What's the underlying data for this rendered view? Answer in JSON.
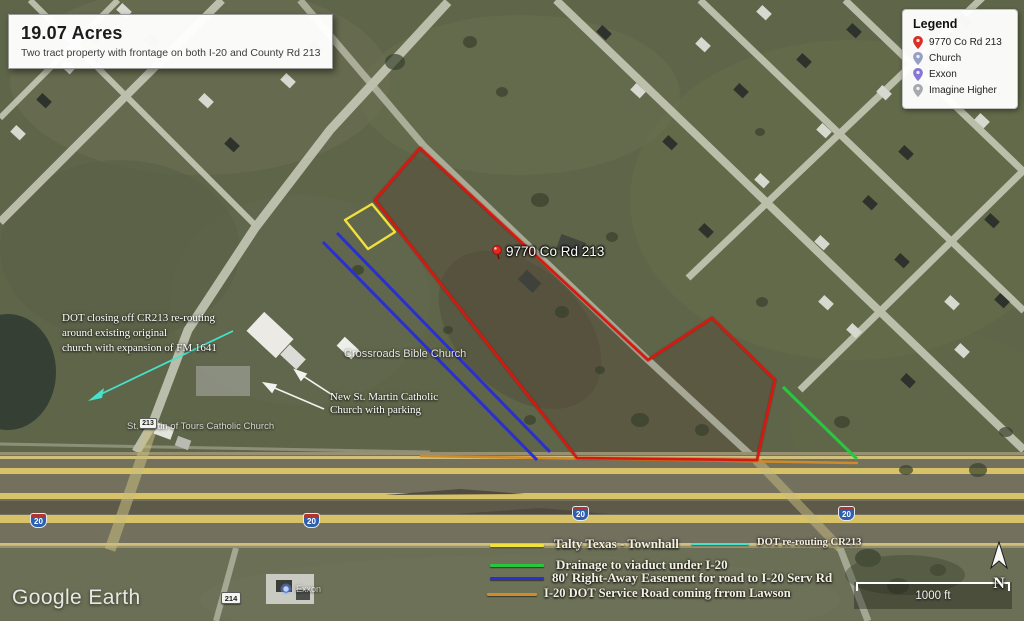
{
  "title_box": {
    "title": "19.07 Acres",
    "subtitle": "Two tract property with frontage on both I-20 and County Rd 213"
  },
  "legend": {
    "title": "Legend",
    "items": [
      {
        "label": "9770 Co Rd 213",
        "pin_color": "#d93025"
      },
      {
        "label": "Church",
        "pin_color": "#97a0c2"
      },
      {
        "label": "Exxon",
        "pin_color": "#8577d6"
      },
      {
        "label": "Imagine Higher",
        "pin_color": "#a6a9ad"
      }
    ]
  },
  "map_labels": {
    "property_pin": "9770 Co Rd 213",
    "crossroads_church": "Crossroads Bible Church",
    "st_martin_church": "St. Martin of Tours Catholic Church",
    "new_church_note": [
      "New St. Martin Catholic",
      "Church with parking"
    ],
    "dot_note": [
      "DOT closing off CR213 re-routing",
      "around existing original",
      "church with expansion of FM 1641"
    ],
    "exxon": "Exxon"
  },
  "shields": {
    "interstate": "20",
    "cr213": "213",
    "cr214": "214"
  },
  "annotation_legend": [
    {
      "label": "Talty Texas - Townhall",
      "color": "#f2e03c"
    },
    {
      "label": "DOT re-routing CR213",
      "color": "#45e2cc"
    },
    {
      "label": "Drainage to viaduct under I-20",
      "color": "#27c840"
    },
    {
      "label": "80' Right-Away Easement for road to I-20 Serv Rd",
      "color": "#2a2fd0"
    },
    {
      "label": "I-20 DOT Service Road coming frrom Lawson",
      "color": "#d08a28"
    }
  ],
  "overlay_colors": {
    "tract_outline": "#ef1d10",
    "yellow_tract": "#f2e03c",
    "easement": "#2a2fd0",
    "drainage": "#27c840",
    "dot_reroute": "#45e2cc",
    "service_road": "#d08a28"
  },
  "footer": {
    "watermark": "Google Earth",
    "scale_label": "1000 ft",
    "north_label": "N"
  }
}
